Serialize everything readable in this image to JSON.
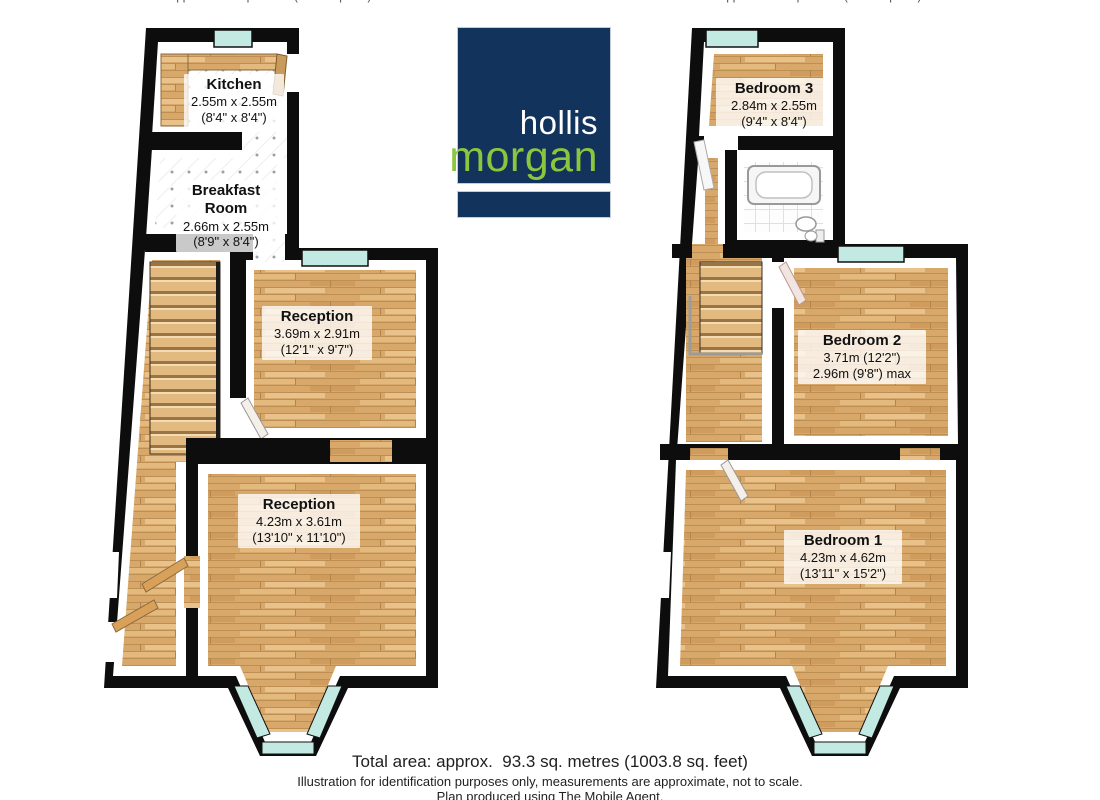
{
  "captions": {
    "ground": "Approx. 46.6 sq. metres (501.6 sq. feet)",
    "first": "Approx. 46.7 sq. metres (502.2 sq. feet)"
  },
  "logo": {
    "name_top": "hollis",
    "name_bottom": "morgan",
    "navy": "#12345c",
    "green": "#8cc63e"
  },
  "rooms": {
    "kitchen": {
      "name": "Kitchen",
      "metric": "2.55m x 2.55m",
      "imperial": "(8'4\" x 8'4\")"
    },
    "breakfast": {
      "name": "Breakfast Room",
      "metric": "2.66m x 2.55m",
      "imperial": "(8'9\" x 8'4\")"
    },
    "reception1": {
      "name": "Reception",
      "metric": "3.69m x 2.91m",
      "imperial": "(12'1\" x 9'7\")"
    },
    "reception2": {
      "name": "Reception",
      "metric": "4.23m x 3.61m",
      "imperial": "(13'10\" x 11'10\")"
    },
    "bedroom3": {
      "name": "Bedroom 3",
      "metric": "2.84m x 2.55m",
      "imperial": "(9'4\" x 8'4\")"
    },
    "bedroom2": {
      "name": "Bedroom 2",
      "metric": "3.71m (12'2\")",
      "imperial": "2.96m (9'8\") max"
    },
    "bedroom1": {
      "name": "Bedroom 1",
      "metric": "4.23m x 4.62m",
      "imperial": "(13'11\" x 15'2\")"
    }
  },
  "footer": {
    "total_area": "Total area: approx.  93.3 sq. metres (1003.8 sq. feet)",
    "disclaimer": "Illustration for identification purposes only, measurements are approximate, not to scale.",
    "produced_by": "Plan produced using The Mobile Agent."
  },
  "colors": {
    "wall": "#0d0d0d",
    "window_glass": "#c3e9e3",
    "wood_floor": "#d8a76a",
    "tile_dot": "#9aa0a8"
  }
}
